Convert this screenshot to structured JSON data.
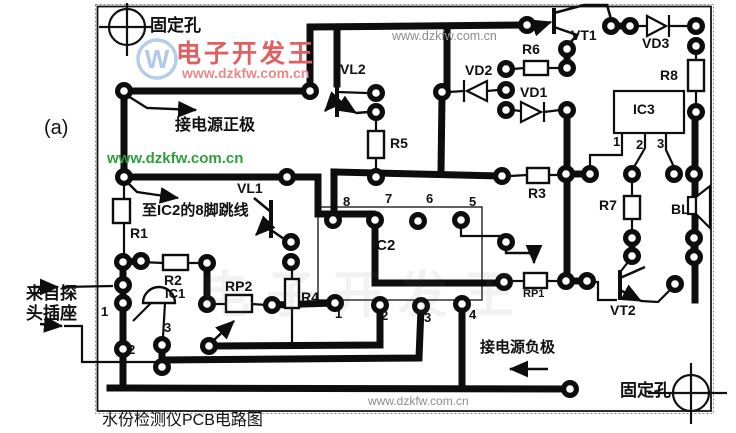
{
  "figure_label": "(a)",
  "caption": "水份检测仪PCB电路图",
  "watermarks": {
    "brand": "电子开发王",
    "logo_letter": "W",
    "url_red": "www.dzkfw.com.cn",
    "url_green": "www.dzkfw.com.cn",
    "url_gray_top": "www.dzkfw.com.cn",
    "url_gray_bottom": "www.dzkfw.com.cn"
  },
  "annotations": {
    "fixing_hole_top_left": "固定孔",
    "fixing_hole_bottom_right": "固定孔",
    "power_positive": "接电源正极",
    "power_negative": "接电源负极",
    "jumper_note": "至IC2的8脚跳线",
    "probe_note_line1": "来自探",
    "probe_note_line2": "头插座"
  },
  "components": {
    "r1": "R1",
    "r2": "R2",
    "r3": "R3",
    "r4": "R4",
    "r5": "R5",
    "r6": "R6",
    "r7": "R7",
    "r8": "R8",
    "rp1": "RP1",
    "rp2": "RP2",
    "ic1": "IC1",
    "ic2": "IC2",
    "ic3": "IC3",
    "vd1": "VD1",
    "vd2": "VD2",
    "vd3": "VD3",
    "vl1": "VL1",
    "vl2": "VL2",
    "vt1": "VT1",
    "vt2": "VT2",
    "bl": "BL"
  },
  "pins": {
    "ic2_top": [
      "8",
      "7",
      "6",
      "5"
    ],
    "ic2_bottom": [
      "1",
      "2",
      "3",
      "4"
    ],
    "ic3": [
      "1",
      "2",
      "3"
    ],
    "ic1": [
      "1",
      "2",
      "3"
    ]
  },
  "colors": {
    "brand_red": "#e06060",
    "logo_blue": "#a8c4e6",
    "watermark_green": "#2f9e3f",
    "watermark_gray": "#8d8d8d",
    "trace_black": "#0d0d0d"
  }
}
